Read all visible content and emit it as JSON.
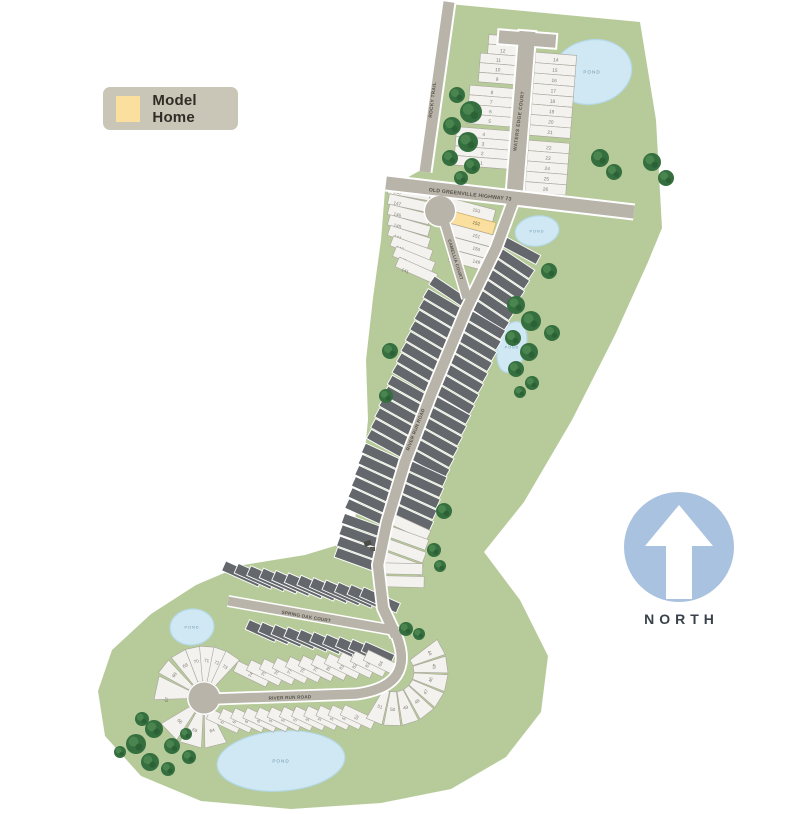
{
  "legend": {
    "model_home_label": "Model Home"
  },
  "north_label": "NORTH",
  "map": {
    "streets": {
      "highway": "OLD GREENVILLE HIGHWAY 73",
      "rocky_trail": "ROCKY TRAIL",
      "waters_edge": "WATERS EDGE COURT",
      "camellia": "CAMELLIA COURT",
      "river_run_spine": "RIVER RUN ROAD",
      "spring_oak": "SPRING OAK COURT",
      "river_run": "RIVER RUN ROAD"
    },
    "pond_label": "POND",
    "lots": {
      "waters_edge_west": [
        13,
        12,
        11,
        10,
        9,
        8,
        7,
        6,
        5,
        4,
        3,
        2,
        1
      ],
      "waters_edge_east": [
        14,
        15,
        16,
        17,
        18,
        19,
        20,
        21,
        22,
        23,
        24,
        25,
        26
      ],
      "camellia_west": [
        148,
        147,
        146,
        145,
        144,
        143,
        142,
        141
      ],
      "camellia_east": [
        153,
        152,
        151,
        150,
        149
      ],
      "model_home_lot": 152,
      "river_run_north": [
        68,
        69,
        70,
        71,
        72,
        73,
        74,
        75,
        76,
        77,
        78,
        79,
        80,
        81,
        82,
        83,
        84
      ],
      "river_run_south": [
        63,
        62,
        61,
        60,
        59,
        58,
        57,
        56,
        55,
        54,
        53,
        52
      ],
      "bend_fan": [
        44,
        45,
        46,
        47,
        48,
        49,
        50,
        51
      ],
      "culdesac_south": [
        66,
        65,
        64
      ],
      "culdesac_west": [
        67
      ]
    },
    "colors": {
      "green": "#b7cb9a",
      "road": "#b9b4a9",
      "lot_available": "#f3f2ee",
      "lot_sold": "#64676b",
      "lot_model": "#fbdf9e",
      "pond_fill": "#cfe8f4",
      "north_blue": "#a9c2e0"
    }
  }
}
